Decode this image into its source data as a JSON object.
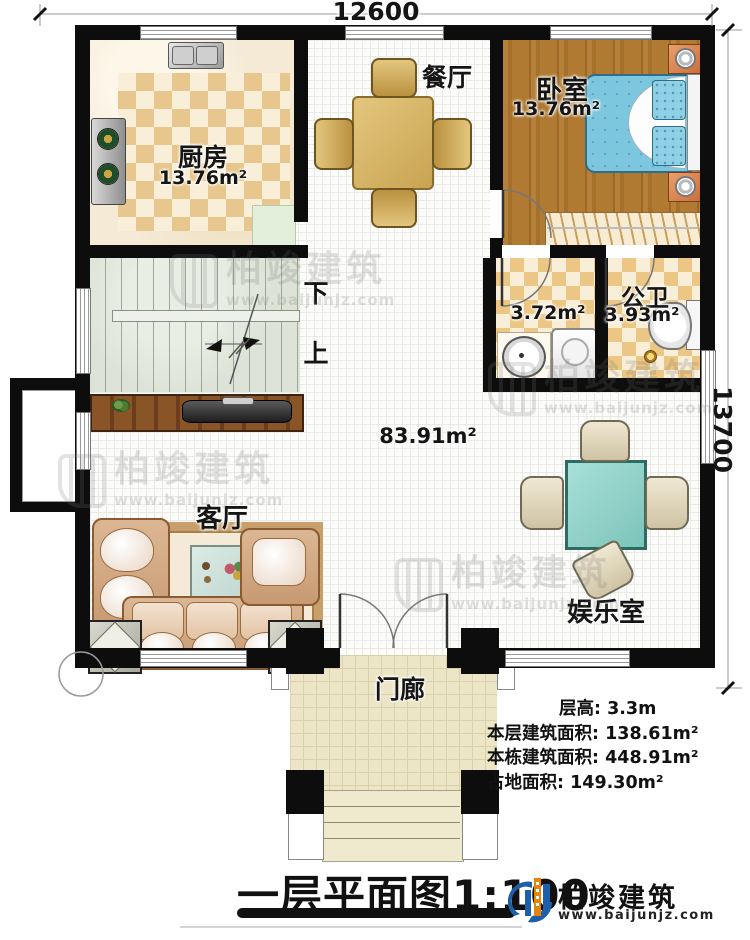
{
  "dimensions": {
    "top": "12600",
    "right": "13700"
  },
  "rooms": {
    "dining": {
      "name": "餐厅"
    },
    "kitchen": {
      "name": "厨房",
      "area": "13.76m²"
    },
    "bedroom": {
      "name": "卧室",
      "area": "13.76m²"
    },
    "laundry": {
      "area": "3.72m²"
    },
    "bathroom": {
      "name": "公卫",
      "area": "3.93m²"
    },
    "stairs": {
      "down": "下",
      "up": "上"
    },
    "hall": {
      "area": "83.91m²"
    },
    "living": {
      "name": "客厅"
    },
    "entertainment": {
      "name": "娱乐室"
    },
    "porch": {
      "name": "门廊"
    }
  },
  "stats": {
    "floor_height": "层高: 3.3m",
    "floor_area": "本层建筑面积: 138.61m²",
    "building_area": "本栋建筑面积: 448.91m²",
    "footprint": "占地面积: 149.30m²"
  },
  "title": "一层平面图1:100",
  "brand": {
    "name": "柏竣建筑",
    "url": "www.baijunjz.com"
  },
  "watermark": {
    "name": "柏竣建筑",
    "url": "www.baijunjz.com"
  },
  "colors": {
    "wall": "#0d0d0d",
    "brand_blue": "#1d5fa8",
    "brand_orange": "#e8830e",
    "bed": "#7cc6de",
    "game_table": "#92d4ca",
    "wood": "#ab772f"
  }
}
